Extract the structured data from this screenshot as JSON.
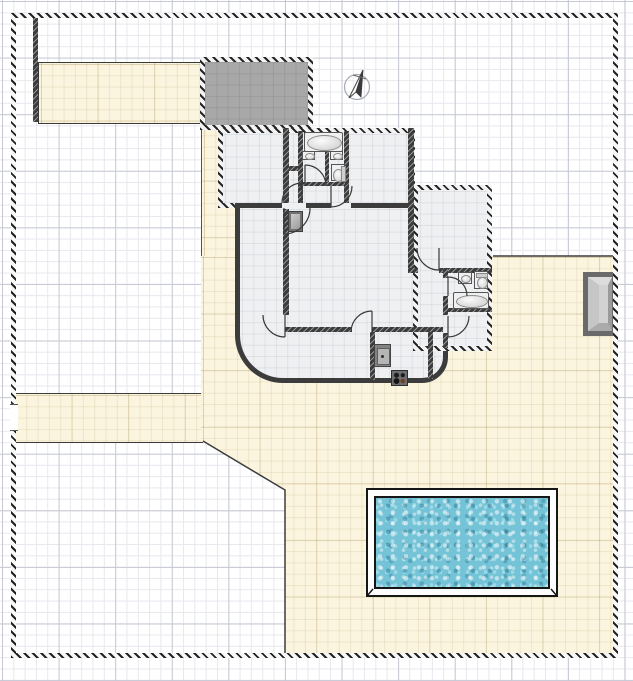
{
  "meta": {
    "view": "floor-plan-canvas",
    "canvas_width": 633,
    "canvas_height": 681,
    "grid_minor_px": 11.3,
    "grid_major_px": 56.6
  },
  "colors": {
    "page_bg": "#ffffff",
    "grid_minor": "#e7e8ee",
    "grid_major": "#c6c9d4",
    "terrace": "#fbf4de",
    "terrace_line": "#3a3a3a",
    "wall": "#3c3c3c",
    "floor": "#eef0f2",
    "garage_fill": "#a8a8a8",
    "boundary": "#2e2e2e",
    "pool_water": "#74c3d6",
    "fixture_fill": "#f0f0f0",
    "fixture_line": "#555555",
    "appliance_dark": "#707070",
    "appliance_light": "#b5b5b5",
    "gate_frame": "#6a6a6a",
    "gate_bevel_light": "#dcdcdc",
    "gate_bevel_mid": "#c6c6c6",
    "gate_bevel_dark": "#9a9a9a",
    "compass_ring": "#9aa0a6",
    "compass_needle": "#333333"
  },
  "site": {
    "boundary_style": "hatched-double-line",
    "west_gate": "opening-in-boundary",
    "east_gate": "beveled-gray-gate",
    "terrace_areas": [
      "north-driveway",
      "west-path",
      "middle-driveway",
      "south-east-courtyard"
    ],
    "lawn_areas": [
      "north-west-lawn",
      "south-west-lawn",
      "north-east-lawn"
    ]
  },
  "house": {
    "rooms": [
      "bedroom-1",
      "closet",
      "bathroom-1-left",
      "bathroom-1-right",
      "bedroom-2",
      "hallway",
      "living-room",
      "kitchen",
      "bedroom-3",
      "bathroom-2",
      "laundry-room"
    ],
    "fixtures": [
      "bathtub-1",
      "sink-1a",
      "sink-1b",
      "toilet-1",
      "heater",
      "wall-oven",
      "stove",
      "sink-2",
      "toilet-2",
      "bathtub-2"
    ],
    "door_count": 9
  },
  "objects": {
    "garage": "gray-roofed-garage",
    "pool": "rectangular-swimming-pool",
    "compass": "north-arrow"
  }
}
